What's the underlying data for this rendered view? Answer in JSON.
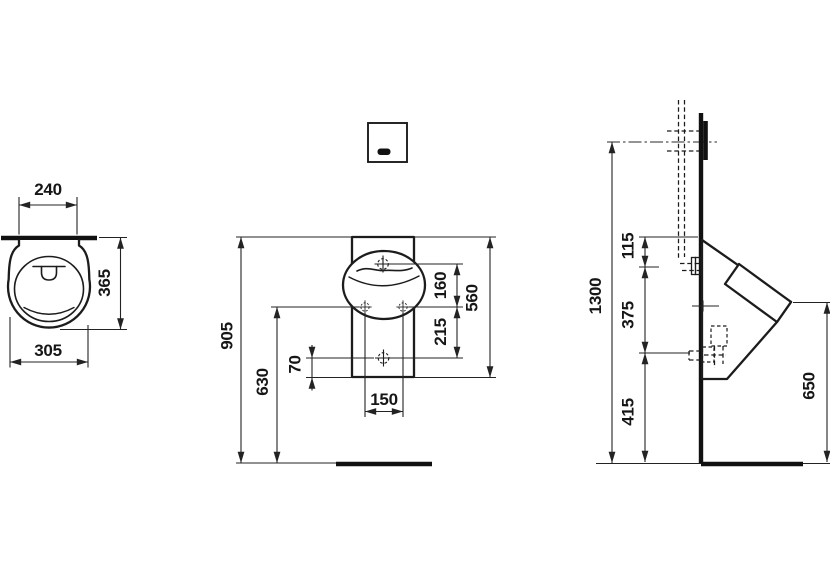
{
  "dims": {
    "top": {
      "width_back": "240",
      "depth": "365",
      "width_max": "305"
    },
    "front": {
      "height_overall": "905",
      "height_to_holes": "630",
      "drain_to_edge": "70",
      "hole_spacing": "150",
      "top_to_holes": "160",
      "holes_to_drain": "215",
      "body_height": "560"
    },
    "side": {
      "sensor_height": "1300",
      "top_to_inlet": "115",
      "inlet_to_outlet": "375",
      "outlet_to_floor": "415",
      "rim_to_floor": "650"
    }
  }
}
